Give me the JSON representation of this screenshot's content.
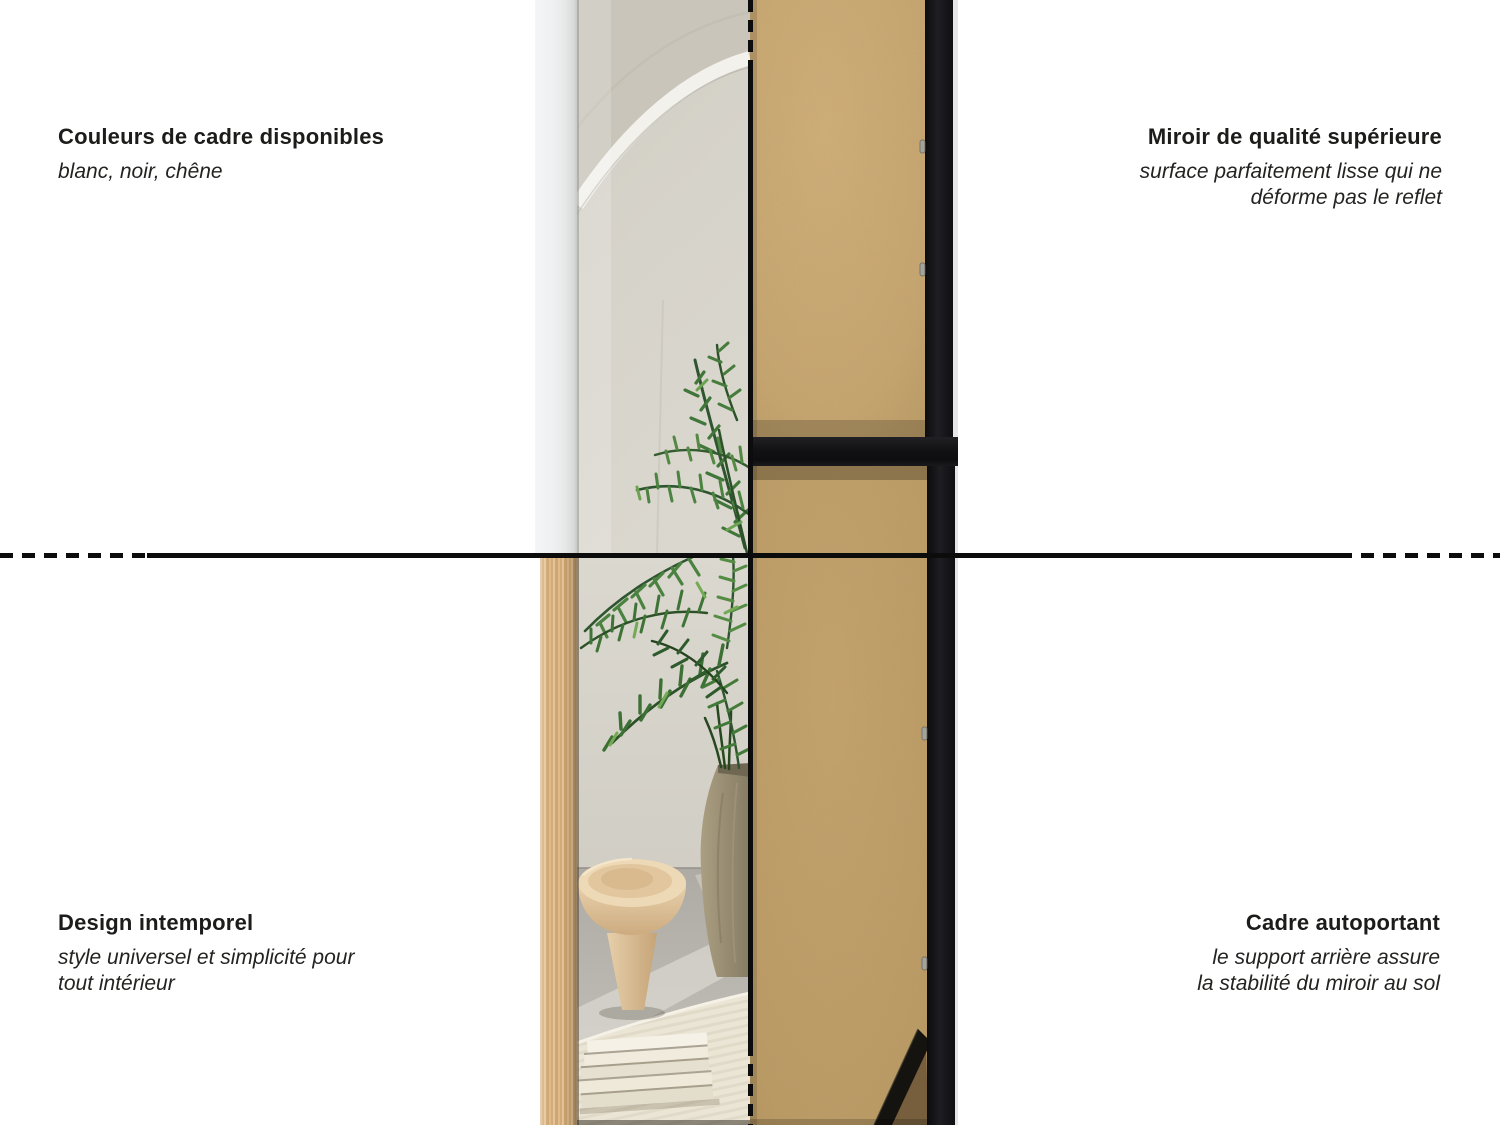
{
  "page": {
    "background": "#ffffff",
    "width": 1500,
    "height": 1125,
    "language": "fr"
  },
  "features": {
    "top_left": {
      "title": "Couleurs de cadre disponibles",
      "description": "blanc, noir, chêne"
    },
    "top_right": {
      "title": "Miroir de qualité supérieure",
      "description": "surface parfaitement lisse qui ne\ndéforme pas le reflet"
    },
    "bottom_left": {
      "title": "Design intemporel",
      "description": "style universel et simplicité pour\ntout intérieur"
    },
    "bottom_right": {
      "title": "Cadre autoportant",
      "description": "le support arrière assure\nla stabilité du miroir au sol"
    }
  },
  "dividers": {
    "color": "#0c0c0c",
    "style": "solid center, dotted ends"
  },
  "product": {
    "subject": "floor standing mirror, front reflection view and kraft back view",
    "frame_colors": {
      "blanc": "#eef0f1",
      "chêne": "#d8b586",
      "noir": "#17171a"
    },
    "back_panel_color": "#c6a46d",
    "support_panel_color": "#bb9a63",
    "text_color": "#1c1c1b"
  }
}
